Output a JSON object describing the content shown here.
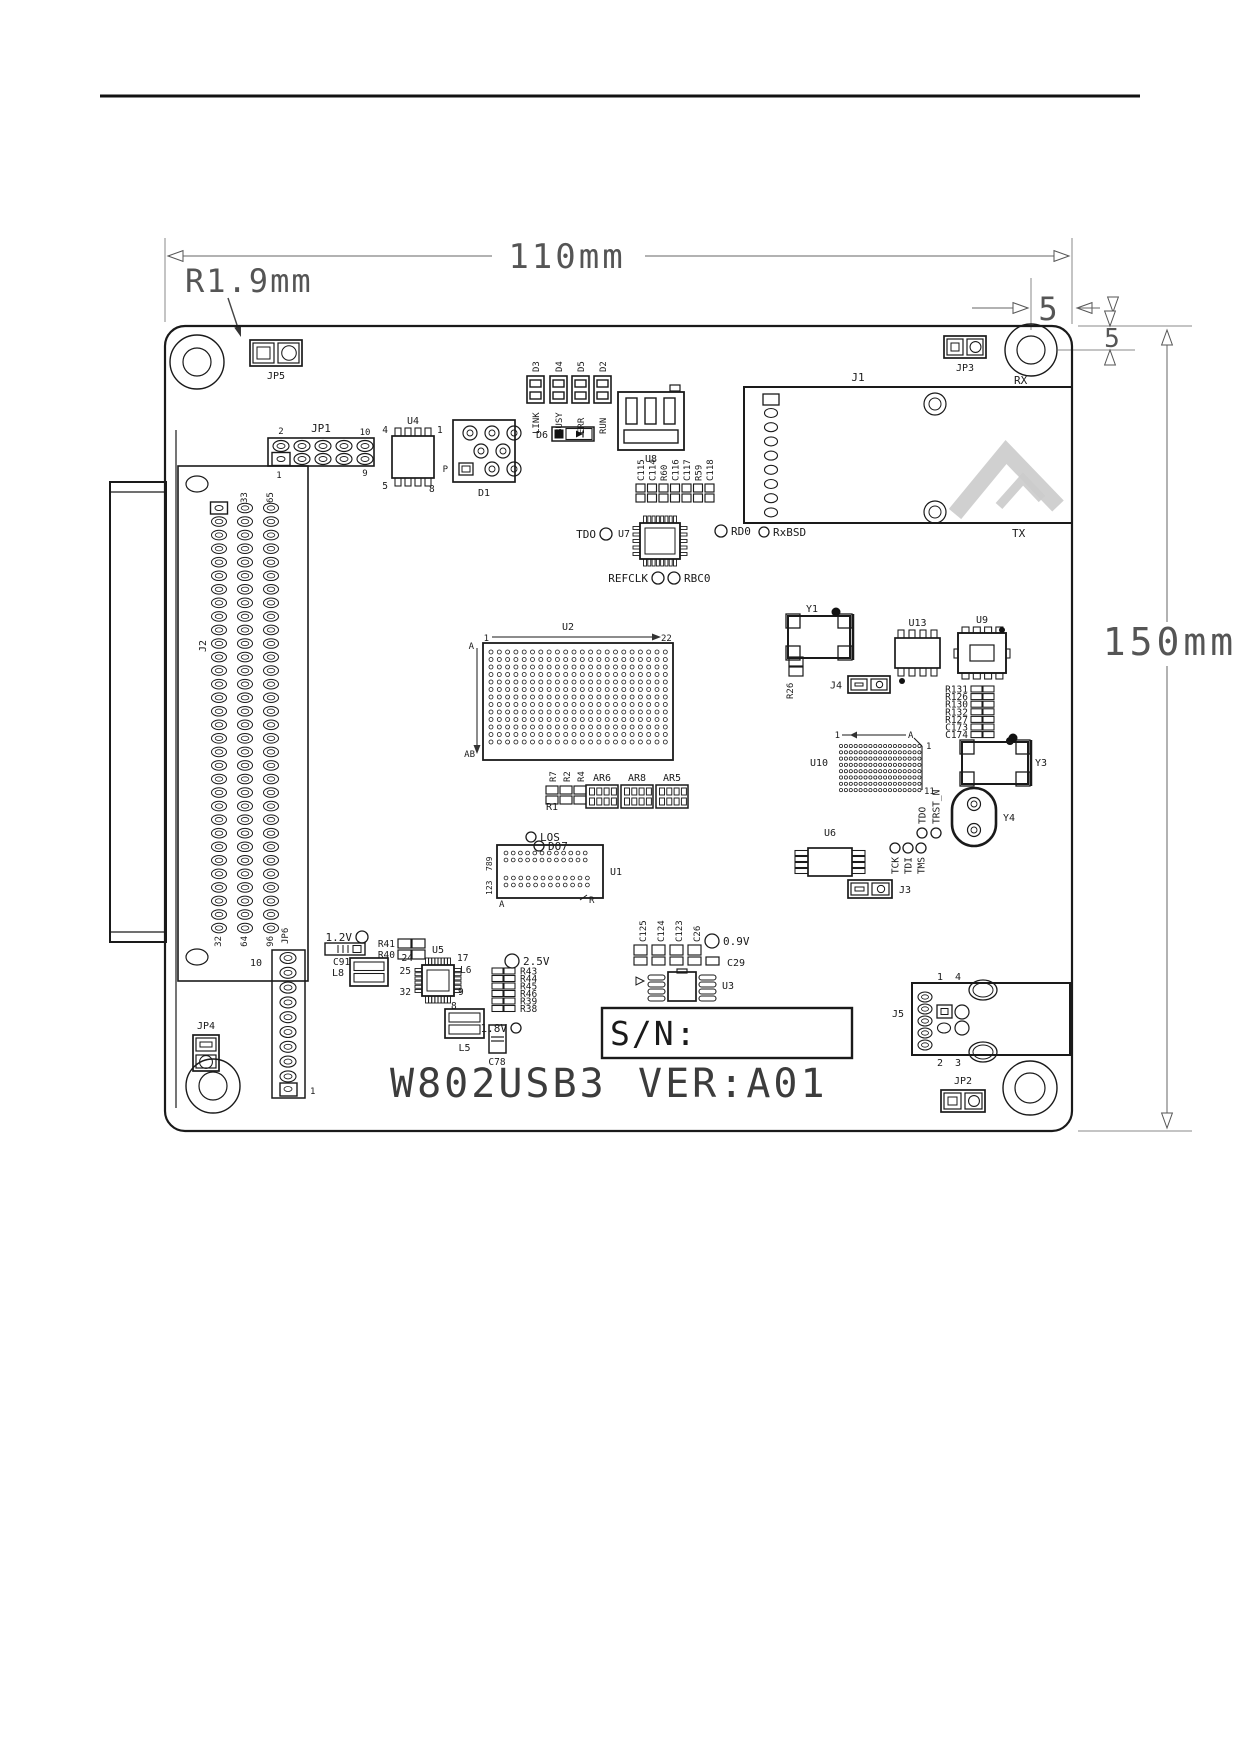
{
  "page": {
    "type": "datasheet-figure",
    "board_title": "W802USB3",
    "board_version": "VER:A01"
  },
  "dimensions": {
    "width": "110mm",
    "height": "150mm",
    "corner_radius": "R1.9mm",
    "hole_offset_x": "5",
    "hole_offset_y": "5"
  },
  "diagram": {
    "components": [
      {
        "n": "page-header-rule",
        "t": "line",
        "x1": 100,
        "y1": 96,
        "x2": 1140,
        "y2": 96,
        "sw": 3,
        "c": "#111"
      },
      {
        "n": "watermark-logo",
        "t": "wm"
      },
      {
        "n": "dim-ext-left",
        "t": "line",
        "x1": 165,
        "y1": 238,
        "x2": 165,
        "y2": 322,
        "sw": 1,
        "c": "#888"
      },
      {
        "n": "dim-ext-right",
        "t": "line",
        "x1": 1072,
        "y1": 238,
        "x2": 1072,
        "y2": 324,
        "sw": 1,
        "c": "#888"
      },
      {
        "n": "dim-110-line-left",
        "t": "line",
        "x1": 168,
        "y1": 256,
        "x2": 492,
        "y2": 256,
        "sw": 1,
        "c": "#666"
      },
      {
        "n": "dim-110-line-right",
        "t": "line",
        "x1": 645,
        "y1": 256,
        "x2": 1069,
        "y2": 256,
        "sw": 1,
        "c": "#666"
      },
      {
        "n": "dim-110-arrow-left",
        "t": "oarr",
        "x": 168,
        "y": 256,
        "d": "l"
      },
      {
        "n": "dim-110-arrow-right",
        "t": "oarr",
        "x": 1069,
        "y": 256,
        "d": "r"
      },
      {
        "n": "dim-width-label",
        "t": "text",
        "x": 567,
        "y": 268,
        "s": 34,
        "a": "m",
        "sp": 3,
        "c": "#555",
        "label": "110mm"
      },
      {
        "n": "dim-radius-label",
        "t": "text",
        "x": 185,
        "y": 292,
        "s": 32,
        "a": "s",
        "sp": 2,
        "c": "#555",
        "label": "R1.9mm"
      },
      {
        "n": "dim-radius-leader",
        "t": "line",
        "x1": 228,
        "y1": 298,
        "x2": 240,
        "y2": 334,
        "sw": 1.4,
        "c": "#444"
      },
      {
        "n": "dim-radius-arrow",
        "t": "farr",
        "x": 241,
        "y": 337,
        "ang": -18,
        "s": 11
      },
      {
        "n": "dim-5h-ext",
        "t": "line",
        "x1": 1031,
        "y1": 278,
        "x2": 1031,
        "y2": 330,
        "sw": 1,
        "c": "#888"
      },
      {
        "n": "dim-5h-line",
        "t": "line",
        "x1": 972,
        "y1": 308,
        "x2": 1028,
        "y2": 308,
        "sw": 1,
        "c": "#666"
      },
      {
        "n": "dim-5h-arrow",
        "t": "oarr",
        "x": 1028,
        "y": 308,
        "d": "r"
      },
      {
        "n": "dim-5h-label",
        "t": "text",
        "x": 1048,
        "y": 320,
        "s": 32,
        "a": "m",
        "c": "#555",
        "label": "5"
      },
      {
        "n": "dim-5h-arrow2",
        "t": "oarr",
        "x": 1077,
        "y": 308,
        "d": "l"
      },
      {
        "n": "dim-5h-line2",
        "t": "line",
        "x1": 1077,
        "y1": 308,
        "x2": 1100,
        "y2": 308,
        "sw": 1,
        "c": "#666"
      },
      {
        "n": "dim-5h-tri",
        "t": "oarr",
        "x": 1113,
        "y": 312,
        "d": "d"
      },
      {
        "n": "dim-top-ext-line",
        "t": "line",
        "x1": 1078,
        "y1": 326,
        "x2": 1192,
        "y2": 326,
        "sw": 1,
        "c": "#888"
      },
      {
        "n": "dim-hole-ext-line",
        "t": "line",
        "x1": 1058,
        "y1": 350,
        "x2": 1135,
        "y2": 350,
        "sw": 1,
        "c": "#888"
      },
      {
        "n": "dim-5v-tri-top",
        "t": "oarr",
        "x": 1110,
        "y": 326,
        "d": "d"
      },
      {
        "n": "dim-5v-label",
        "t": "text",
        "x": 1112,
        "y": 347,
        "s": 26,
        "a": "m",
        "c": "#555",
        "label": "5"
      },
      {
        "n": "dim-5v-tri-bottom",
        "t": "oarr",
        "x": 1110,
        "y": 350,
        "d": "u"
      },
      {
        "n": "dim-150-line",
        "t": "line",
        "x1": 1167,
        "y1": 330,
        "x2": 1167,
        "y2": 1128,
        "sw": 1,
        "c": "#666"
      },
      {
        "n": "dim-150-arrow-top",
        "t": "oarr",
        "x": 1167,
        "y": 330,
        "d": "u"
      },
      {
        "n": "dim-150-arrow-bottom",
        "t": "oarr",
        "x": 1167,
        "y": 1128,
        "d": "d"
      },
      {
        "n": "dim-height-label-bg",
        "t": "rect",
        "x": 1098,
        "y": 622,
        "w": 142,
        "h": 44,
        "sw": 0,
        "f": "#fff"
      },
      {
        "n": "dim-height-label",
        "t": "text",
        "x": 1170,
        "y": 655,
        "s": 38,
        "a": "m",
        "sp": 4,
        "c": "#555",
        "label": "150mm"
      },
      {
        "n": "dim-bottom-ext-line",
        "t": "line",
        "x1": 1078,
        "y1": 1131,
        "x2": 1192,
        "y2": 1131,
        "sw": 1,
        "c": "#888"
      },
      {
        "n": "board-outline",
        "t": "rect",
        "x": 165,
        "y": 326,
        "w": 907,
        "h": 805,
        "rx": 20,
        "sw": 2.2
      },
      {
        "n": "mount-hole-top-left",
        "t": "hole",
        "cx": 197,
        "cy": 362,
        "ro": 27,
        "ri": 14
      },
      {
        "n": "mount-hole-top-right",
        "t": "hole",
        "cx": 1031,
        "cy": 350,
        "ro": 26,
        "ri": 14
      },
      {
        "n": "mount-hole-bottom-left",
        "t": "hole",
        "cx": 213,
        "cy": 1086,
        "ro": 27,
        "ri": 14
      },
      {
        "n": "mount-hole-bottom-right",
        "t": "hole",
        "cx": 1030,
        "cy": 1088,
        "ro": 27,
        "ri": 15
      },
      {
        "n": "jumper-jp5",
        "t": "jmp",
        "x": 250,
        "y": 340,
        "w": 52,
        "h": 26,
        "label": "JP5",
        "lp": "b"
      },
      {
        "n": "jumper-jp3",
        "t": "jmp",
        "x": 944,
        "y": 336,
        "w": 42,
        "h": 22,
        "label": "JP3",
        "lp": "b"
      },
      {
        "n": "jumper-jp2",
        "t": "jmp",
        "x": 941,
        "y": 1090,
        "w": 44,
        "h": 22,
        "label": "JP2",
        "lp": "t"
      },
      {
        "n": "jumper-jp4",
        "t": "jmp",
        "x": 193,
        "y": 1035,
        "w": 26,
        "h": 36,
        "v": 1,
        "label": "JP4",
        "lp": "t"
      },
      {
        "n": "jumper-j3",
        "t": "jmp",
        "x": 848,
        "y": 880,
        "w": 44,
        "h": 18,
        "label": "J3",
        "lp": "r"
      },
      {
        "n": "jumper-j4",
        "t": "jmp",
        "x": 848,
        "y": 676,
        "w": 42,
        "h": 17,
        "label": "J4",
        "lp": "l"
      },
      {
        "n": "led-d3",
        "t": "led",
        "x": 527,
        "y": 376,
        "label": "D3",
        "name": "LINK"
      },
      {
        "n": "led-d4",
        "t": "led",
        "x": 550,
        "y": 376,
        "label": "D4",
        "name": "BUSY"
      },
      {
        "n": "led-d5",
        "t": "led",
        "x": 572,
        "y": 376,
        "label": "D5",
        "name": "ERR"
      },
      {
        "n": "led-d2",
        "t": "led",
        "x": 594,
        "y": 376,
        "label": "D2",
        "name": "RUN"
      },
      {
        "n": "usb-connector-u8",
        "t": "usb",
        "x": 618,
        "y": 392,
        "label": "U8"
      },
      {
        "n": "diode-d6",
        "t": "diode",
        "x": 552,
        "y": 427,
        "label": "D6"
      },
      {
        "n": "header-jp1",
        "t": "hdr25",
        "x": 268,
        "y": 438,
        "label": "JP1",
        "tl": "2",
        "tr": "10",
        "bl": "1",
        "br": "9"
      },
      {
        "n": "ic-u4",
        "t": "soic",
        "x": 392,
        "y": 436,
        "w": 42,
        "h": 42,
        "np": 4,
        "o": "h",
        "label": "U4",
        "xl": [
          {
            "l": "4",
            "x": 388,
            "y": 433,
            "a": "e"
          },
          {
            "l": "1",
            "x": 437,
            "y": 433,
            "a": "s"
          },
          {
            "l": "5",
            "x": 388,
            "y": 489,
            "a": "e"
          },
          {
            "l": "8",
            "x": 429,
            "y": 492,
            "a": "s"
          }
        ]
      },
      {
        "n": "component-d1",
        "t": "d1",
        "label": "D1",
        "p": "P"
      },
      {
        "n": "cap-row-c115",
        "t": "caps",
        "x": 636,
        "y": 484,
        "st": 11.5,
        "cw": 9,
        "ch": 8,
        "labels": [
          "C115",
          "C114",
          "R60",
          "C116",
          "C117",
          "R59",
          "C118"
        ]
      },
      {
        "n": "ic-u7",
        "t": "qfp",
        "x": 640,
        "y": 523,
        "w": 40,
        "h": 36,
        "pt": 8,
        "ps": 5,
        "label": "U7",
        "lp": "l"
      },
      {
        "n": "signal-tdo",
        "t": "lcirc",
        "cx": 606,
        "cy": 534,
        "r": 6,
        "side": "l",
        "label": "TDO"
      },
      {
        "n": "signal-refclk",
        "t": "lcirc",
        "cx": 658,
        "cy": 578,
        "r": 6,
        "side": "l",
        "label": "REFCLK"
      },
      {
        "n": "signal-rbc0",
        "t": "lcirc",
        "cx": 674,
        "cy": 578,
        "r": 6,
        "side": "r",
        "label": "RBC0"
      },
      {
        "n": "signal-rd0",
        "t": "lcirc",
        "cx": 721,
        "cy": 531,
        "r": 6,
        "side": "r",
        "label": "RD0"
      },
      {
        "n": "signal-rxbsd",
        "t": "lcirc",
        "cx": 764,
        "cy": 532,
        "r": 5,
        "side": "r",
        "label": "RxBSD"
      },
      {
        "n": "connector-j1",
        "t": "j1",
        "x": 744,
        "y": 387,
        "w": 328,
        "h": 136,
        "label": "J1",
        "rxl": "RX",
        "txl": "TX"
      },
      {
        "n": "connector-j2",
        "t": "j2",
        "label": "J2",
        "top": [
          "33",
          "65"
        ],
        "bottom": [
          "32",
          "64",
          "96"
        ]
      },
      {
        "n": "bga-u2",
        "t": "u2",
        "x": 483,
        "y": 643,
        "label": "U2",
        "l1": "1",
        "l2": "22",
        "l3": "A",
        "l4": "AB"
      },
      {
        "n": "crystal-y1",
        "t": "xtal",
        "x": 788,
        "y": 616,
        "w": 62,
        "h": 42,
        "label": "Y1",
        "lx": 806,
        "ly": 612,
        "dot": [
          836,
          612
        ]
      },
      {
        "n": "resistor-r26",
        "t": "res2v",
        "x": 789,
        "y": 657,
        "label": "R26"
      },
      {
        "n": "ic-u13",
        "t": "soic",
        "x": 895,
        "y": 638,
        "w": 45,
        "h": 30,
        "np": 4,
        "o": "h",
        "label": "U13",
        "dot": [
          902,
          681
        ]
      },
      {
        "n": "ic-u9",
        "t": "qfn",
        "x": 958,
        "y": 633,
        "w": 48,
        "h": 40,
        "label": "U9"
      },
      {
        "n": "resistor-stack-r131",
        "t": "rstack",
        "x": 971,
        "y": 686,
        "st": 7.6,
        "side": "l",
        "dot": [
          1010,
          741
        ],
        "labels": [
          "R131",
          "R126",
          "R130",
          "R132",
          "R127",
          "C173",
          "C174"
        ]
      },
      {
        "n": "bga-u10",
        "t": "u10",
        "x": 835,
        "y": 740,
        "label": "U10",
        "l1": "1",
        "l2": "A",
        "lr1": "1",
        "lr2": "11"
      },
      {
        "n": "crystal-y3",
        "t": "xtal",
        "x": 962,
        "y": 742,
        "w": 66,
        "h": 42,
        "label": "Y3",
        "lx": 1035,
        "ly": 766,
        "dot": [
          1013,
          738
        ]
      },
      {
        "n": "oscillator-y4",
        "t": "osc",
        "x": 952,
        "y": 788,
        "w": 44,
        "h": 58,
        "label": "Y4"
      },
      {
        "n": "signal-tdo-jtag",
        "t": "vcirc",
        "cx": 922,
        "cy": 833,
        "r": 5,
        "dir": "up",
        "label": "TDO"
      },
      {
        "n": "signal-trst-n",
        "t": "vcirc",
        "cx": 936,
        "cy": 833,
        "r": 5,
        "dir": "up",
        "label": "TRST_N"
      },
      {
        "n": "signal-tck",
        "t": "vcirc",
        "cx": 895,
        "cy": 848,
        "r": 5,
        "dir": "down",
        "label": "TCK"
      },
      {
        "n": "signal-tdi",
        "t": "vcirc",
        "cx": 908,
        "cy": 848,
        "r": 5,
        "dir": "down",
        "label": "TDI"
      },
      {
        "n": "signal-tms",
        "t": "vcirc",
        "cx": 921,
        "cy": 848,
        "r": 5,
        "dir": "down",
        "label": "TMS"
      },
      {
        "n": "ic-u6",
        "t": "soic",
        "x": 808,
        "y": 848,
        "w": 44,
        "h": 28,
        "np": 4,
        "o": "v",
        "label": "U6"
      },
      {
        "n": "signal-los",
        "t": "lcirc",
        "cx": 531,
        "cy": 837,
        "r": 5,
        "side": "r",
        "label": "LOS"
      },
      {
        "n": "signal-do7",
        "t": "lcirc",
        "cx": 539,
        "cy": 846,
        "r": 5,
        "side": "r",
        "label": "DO7"
      },
      {
        "n": "ic-u1",
        "t": "u1",
        "x": 497,
        "y": 845,
        "label": "U1",
        "l789": "789",
        "l123": "123",
        "la": "A",
        "lr": "R"
      },
      {
        "n": "resistor-group-r7",
        "t": "rgrp",
        "x": 546,
        "y": 786,
        "labels": [
          "R7",
          "R2",
          "R4"
        ],
        "bottom": "R1"
      },
      {
        "n": "resistor-array-ar6",
        "t": "rarr",
        "x": 586,
        "y": 785,
        "label": "AR6"
      },
      {
        "n": "resistor-array-ar8",
        "t": "rarr",
        "x": 621,
        "y": 785,
        "label": "AR8"
      },
      {
        "n": "resistor-array-ar5",
        "t": "rarr",
        "x": 656,
        "y": 785,
        "label": "AR5"
      },
      {
        "n": "rail-1v2",
        "t": "lcirc",
        "cx": 362,
        "cy": 937,
        "r": 6,
        "side": "l",
        "label": "1.2V"
      },
      {
        "n": "cap-c91",
        "t": "capr",
        "x": 325,
        "y": 943,
        "label": "C91"
      },
      {
        "n": "inductor-l8",
        "t": "lbox",
        "x": 350,
        "y": 958,
        "w": 38,
        "h": 28,
        "label": "L8",
        "lp": "l"
      },
      {
        "n": "resistor-r41",
        "t": "res2h",
        "x": 398,
        "y": 939,
        "label": "R41"
      },
      {
        "n": "resistor-r40",
        "t": "res2h",
        "x": 398,
        "y": 950,
        "label": "R40"
      },
      {
        "n": "ic-u5",
        "t": "qfp",
        "x": 422,
        "y": 965,
        "w": 32,
        "h": 31,
        "pt": 8,
        "ps": 6,
        "label": "U5",
        "lp": "t",
        "xl": [
          {
            "l": "24",
            "x": 413,
            "y": 961,
            "a": "e"
          },
          {
            "l": "17",
            "x": 457,
            "y": 961,
            "a": "s"
          },
          {
            "l": "25",
            "x": 411,
            "y": 974,
            "a": "e"
          },
          {
            "l": "32",
            "x": 411,
            "y": 995,
            "a": "e"
          },
          {
            "l": "9",
            "x": 458,
            "y": 995,
            "a": "s"
          },
          {
            "l": "8",
            "x": 451,
            "y": 1009,
            "a": "s"
          },
          {
            "l": "L6",
            "x": 460,
            "y": 973,
            "a": "s"
          }
        ]
      },
      {
        "n": "inductor-l5",
        "t": "lbox",
        "x": 445,
        "y": 1009,
        "w": 39,
        "h": 29,
        "label": "L5",
        "lp": "b"
      },
      {
        "n": "rail-2v5",
        "t": "lcirc",
        "cx": 512,
        "cy": 961,
        "r": 7,
        "side": "r",
        "label": "2.5V"
      },
      {
        "n": "resistor-stack-r43",
        "t": "rstack",
        "x": 492,
        "y": 968,
        "st": 7.5,
        "side": "r",
        "labels": [
          "R43",
          "R44",
          "R45",
          "R46",
          "R39",
          "R38"
        ]
      },
      {
        "n": "rail-1v8",
        "t": "lcirc",
        "cx": 516,
        "cy": 1028,
        "r": 5,
        "side": "l",
        "label": "1.8V"
      },
      {
        "n": "cap-c78",
        "t": "capv",
        "x": 489,
        "y": 1025,
        "label": "C78"
      },
      {
        "n": "cap-row-c125",
        "t": "caps",
        "x": 634,
        "y": 945,
        "st": 18,
        "cw": 13,
        "ch": 10,
        "ch2": 8,
        "labels": [
          "C125",
          "C124",
          "C123",
          "C26"
        ]
      },
      {
        "n": "cap-c29-body",
        "t": "rect",
        "x": 706,
        "y": 957,
        "w": 13,
        "h": 8,
        "sw": 1.2
      },
      {
        "n": "cap-c29-label",
        "t": "text",
        "x": 727,
        "y": 966,
        "s": 10,
        "a": "s",
        "label": "C29"
      },
      {
        "n": "rail-0v9",
        "t": "lcirc",
        "cx": 712,
        "cy": 941,
        "r": 7,
        "side": "r",
        "label": "0.9V"
      },
      {
        "n": "ic-u3",
        "t": "u3",
        "x": 668,
        "y": 972,
        "label": "U3"
      },
      {
        "n": "header-jp6",
        "t": "jp6",
        "label": "JP6",
        "p10": "10",
        "p1": "1"
      },
      {
        "n": "connector-j5",
        "t": "j5",
        "x": 912,
        "y": 983,
        "label": "J5",
        "p1": "1",
        "p4": "4",
        "p2": "2",
        "p3": "3"
      },
      {
        "n": "serial-number-box",
        "t": "snbox",
        "x": 602,
        "y": 1008,
        "w": 250,
        "h": 50,
        "label": "S/N:"
      },
      {
        "n": "board-title",
        "t": "text",
        "x": 390,
        "y": 1097,
        "s": 40,
        "a": "s",
        "sp": 3,
        "c": "#3c3c3c",
        "label": "W802USB3"
      },
      {
        "n": "board-version",
        "t": "text",
        "x": 638,
        "y": 1097,
        "s": 40,
        "a": "s",
        "sp": 3,
        "c": "#3c3c3c",
        "label": "VER:A01"
      }
    ]
  }
}
